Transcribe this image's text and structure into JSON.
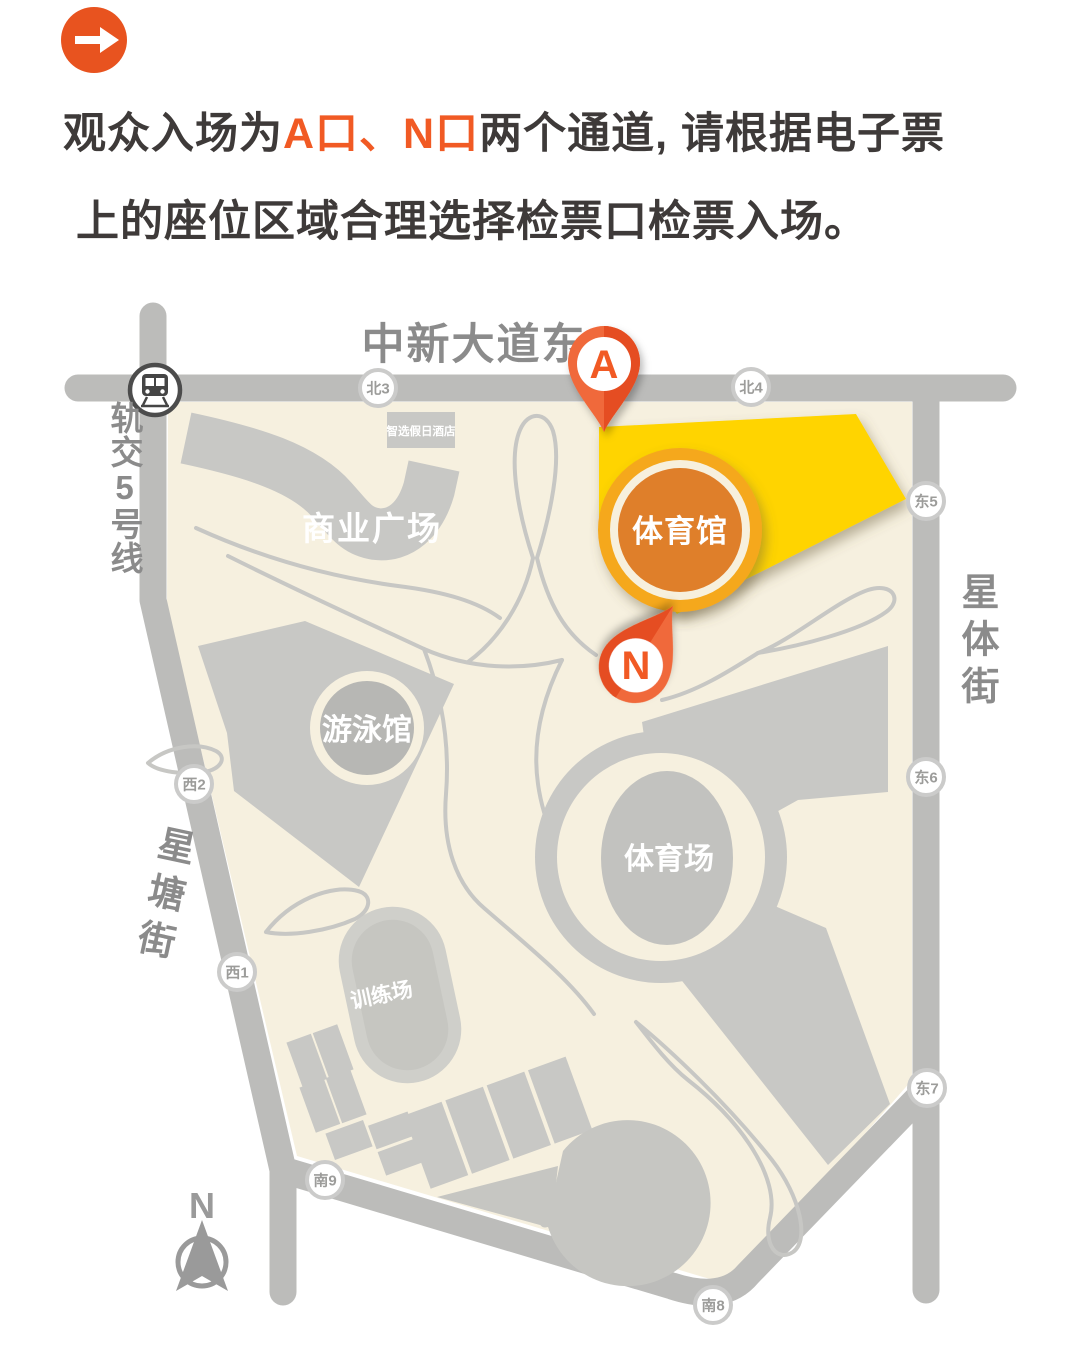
{
  "header": {
    "icon": "arrow-right-icon",
    "line1_prefix": "观众入场为",
    "line1_highlight": "A口、N口",
    "line1_suffix": "两个通道, 请根据电子票",
    "line2": "上的座位区域合理选择检票口检票入场。"
  },
  "map": {
    "streets": {
      "north_avenue": "中新大道东",
      "metro": "轨交5号线",
      "east": "星体街",
      "west": "星塘街"
    },
    "venues": {
      "arena": "体育馆",
      "stadium": "体育场",
      "pool": "游泳馆",
      "training": "训练场",
      "plaza": "商业广场",
      "hotel": "智选假日酒店"
    },
    "gates": {
      "n3": "北3",
      "n4": "北4",
      "e5": "东5",
      "e6": "东6",
      "e7": "东7",
      "s8": "南8",
      "s9": "南9",
      "w1": "西1",
      "w2": "西2"
    },
    "pins": {
      "a": "A",
      "n": "N"
    },
    "compass_n": "N"
  },
  "colors": {
    "accent_orange": "#F15A24",
    "pin_orange": "#EE5A2B",
    "highlight_yellow": "#FFD400",
    "arena_fill": "#DF7F2A",
    "arena_ring": "#F5A81E",
    "map_cream": "#F6F0DF",
    "road_gray": "#BCBCBA",
    "building_gray": "#C8C8C5",
    "title_text": "#3E3A39",
    "street_text": "#8B8B8B"
  }
}
